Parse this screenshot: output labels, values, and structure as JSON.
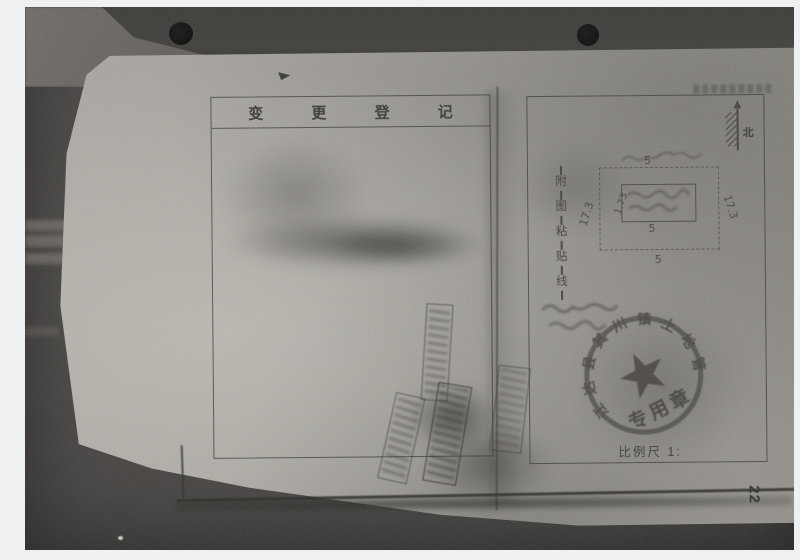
{
  "photo_alt": "Photocopy of a Chinese land change-registration ledger spread",
  "left_page": {
    "title": "变 更 登 记"
  },
  "right_page": {
    "north_label": "北",
    "paste_line": {
      "chars": [
        "附",
        "图",
        "粘",
        "贴",
        "线"
      ]
    },
    "sketch": {
      "top_width": "5",
      "inner_width": "5",
      "bottom_width": "5",
      "left_length": "17.3",
      "right_length": "17.3",
      "inner_length": "1.73"
    },
    "seal": {
      "arc_text": "江达县其川镇土地管理",
      "bottom_text": "专用章"
    },
    "scale_label": "比例尺 1:"
  },
  "page_number": "22",
  "colors": {
    "paper": "#a5a29c",
    "background": "#413e3b",
    "ink": "#3c3a37",
    "pencil": "#55524e"
  }
}
